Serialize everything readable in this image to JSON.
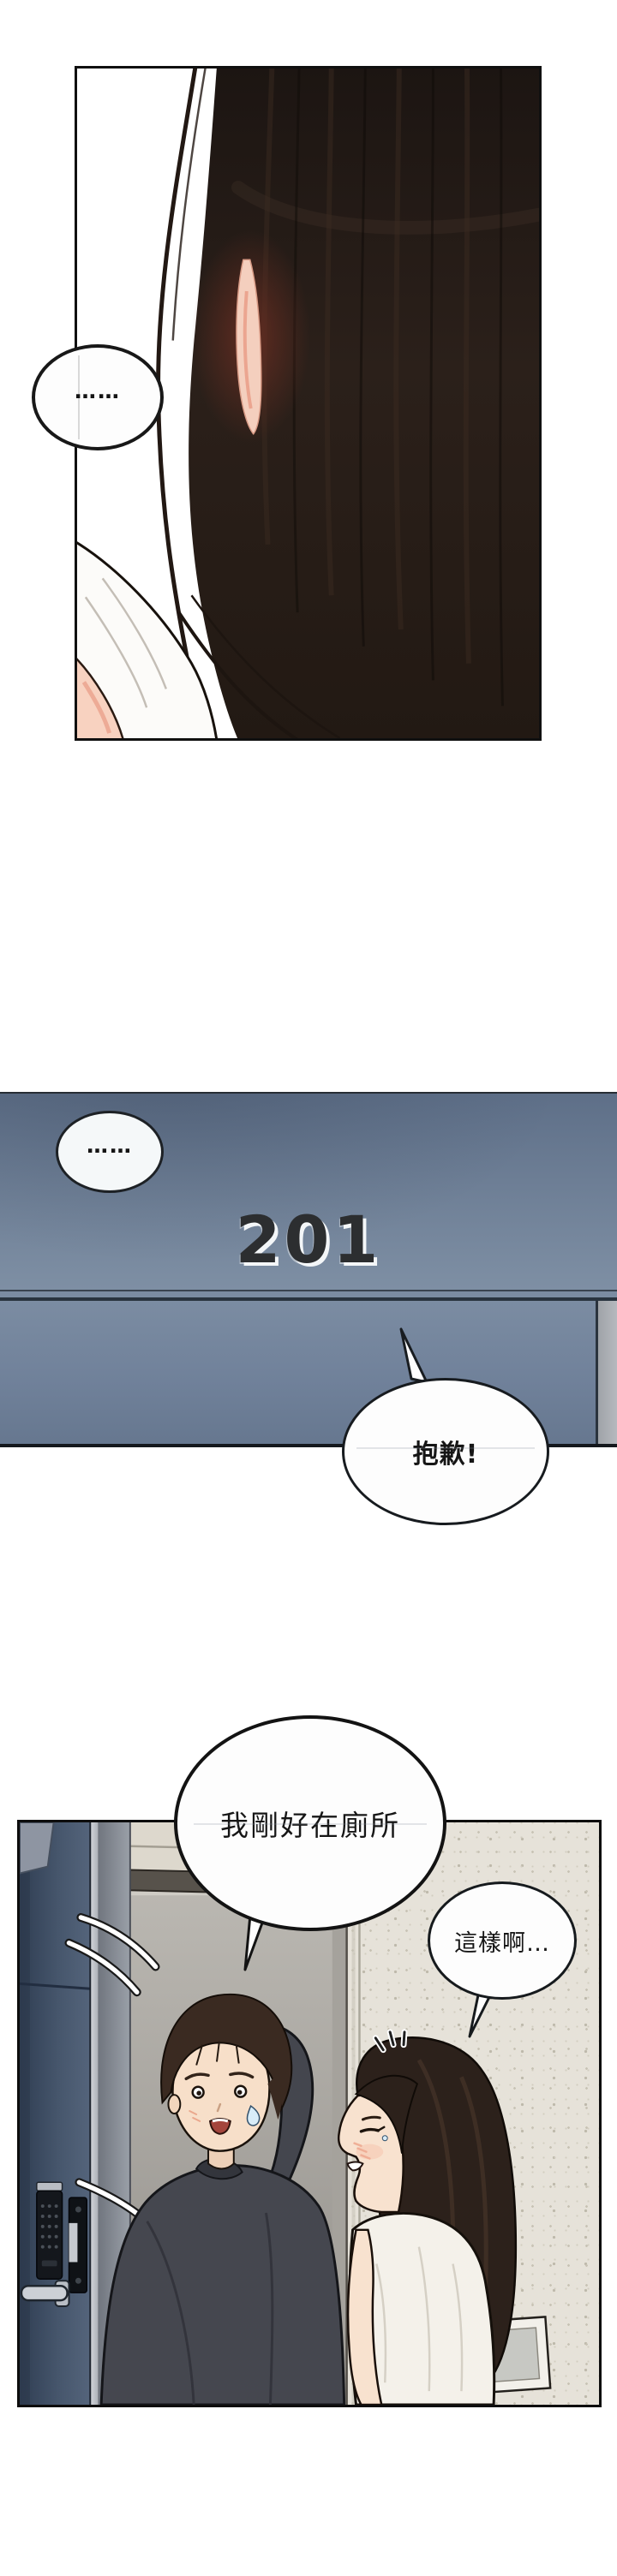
{
  "comic": {
    "type": "webtoon-page",
    "panel1": {
      "silence_bubble_text": "……"
    },
    "panel2": {
      "silence_bubble_text": "……",
      "door_number": "201",
      "sorry_bubble_text": "抱歉!"
    },
    "panel3": {
      "man_bubble_text": "我剛好在廁所",
      "woman_bubble_text": "這樣啊…"
    },
    "colors": {
      "page_background": "#ffffff",
      "hall_wall_blue_top": "#5e6f88",
      "hall_wall_blue_bottom": "#7b8ca2",
      "door_frame_strip": "#b0b4b9",
      "door_number_text": "#2c2e30",
      "panel3_wall_beige": "#e6e2d9",
      "apartment_door_navy": "#46566c",
      "hair_dark_brown": "#2c211b",
      "man_sweater_charcoal": "#45474f",
      "skin_tone": "#f7dfc9"
    }
  }
}
